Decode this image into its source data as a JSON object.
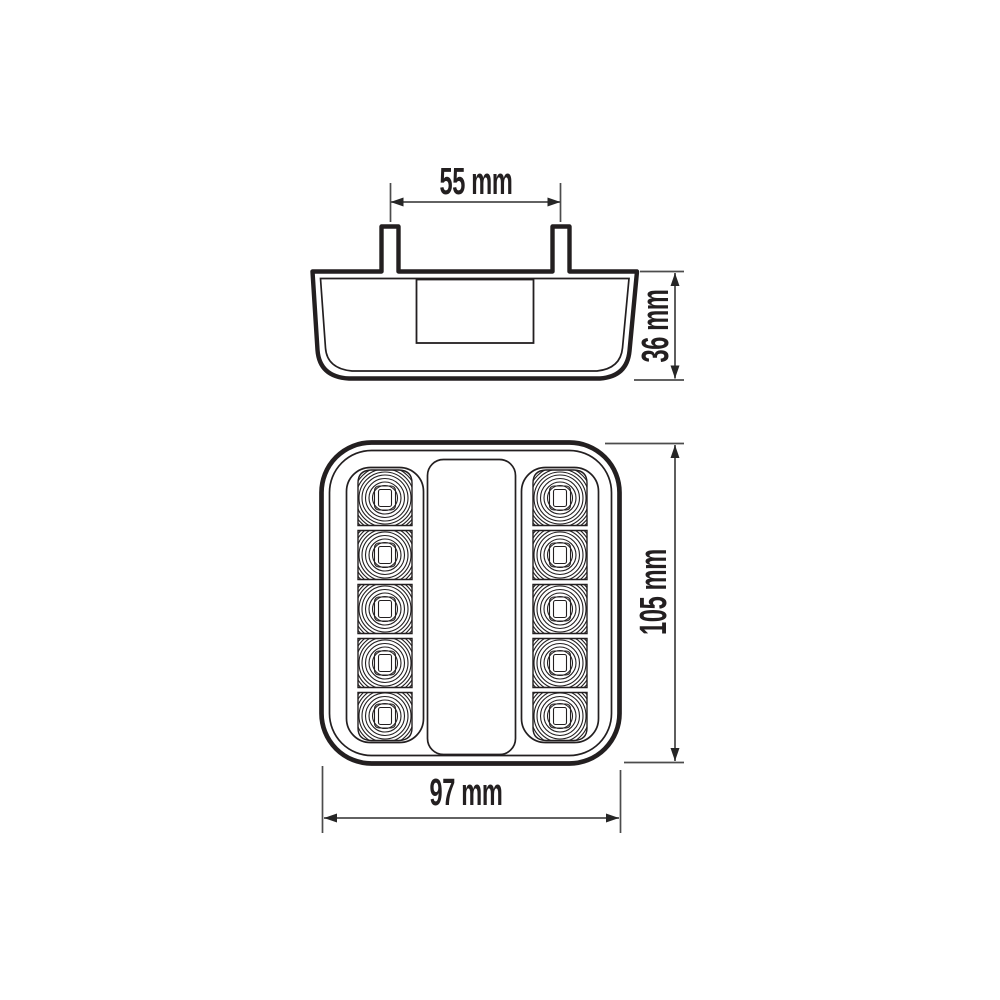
{
  "drawing": {
    "background": "#ffffff",
    "line_color": "#231f20",
    "dimension_line_color": "#4c4c4c",
    "arrow_color": "#262626",
    "text_color": "#231f20",
    "labels": {
      "stud_spacing": "55 mm",
      "side_height": "36 mm",
      "front_height": "105 mm",
      "front_width": "97 mm"
    },
    "front_view": {
      "led_columns": 2,
      "leds_per_column": 5
    }
  }
}
